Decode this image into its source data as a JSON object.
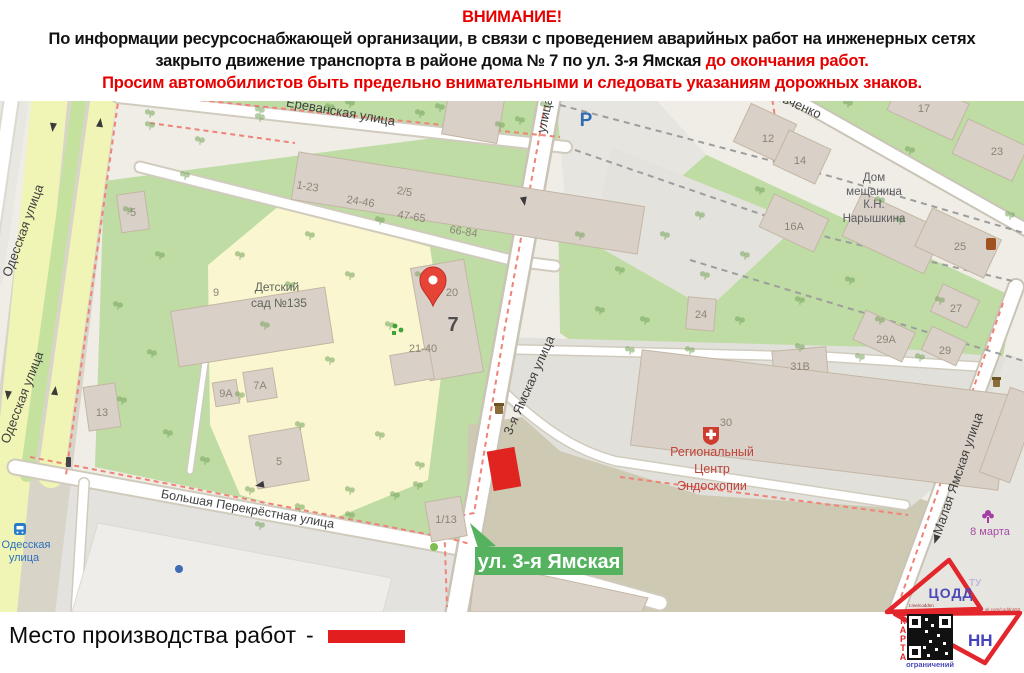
{
  "notice": {
    "line1": "ВНИМАНИЕ!",
    "line2": "По информации ресурсоснабжающей организации, в связи с проведением аварийных работ на инженерных сетях",
    "line3_black": "закрыто движение транспорта в районе дома № 7 по ул. 3-я Ямская ",
    "line3_red": "до окончания работ.",
    "line4": "Просим автомобилистов быть предельно внимательными и следовать указаниям дорожных знаков."
  },
  "legend": {
    "label": "Место производства работ",
    "dash": "-"
  },
  "colors": {
    "notice_red": "#e60000",
    "work_marker_red": "#e02420",
    "banner_green": "#55b25e",
    "logo_red": "#e3262c",
    "logo_blue": "#4b49b8"
  },
  "map": {
    "banner": "ул. 3-я Ямская",
    "parking": "P",
    "streets": {
      "yerevanskaya": "Ереванская улица",
      "odesskaya": "Одесская улица",
      "yamskaya_top": "улица",
      "yamskaya": "3-я Ямская улица",
      "perekrestnaya": "Большая Перекрёстная улица",
      "malaya_yamskaya": "Малая Ямская улица",
      "shevchenko": "евченко"
    },
    "pois": {
      "kindergarten": [
        "Детский",
        "сад №135"
      ],
      "endoscopy": [
        "Региональный",
        "Центр",
        "Эндоскопии"
      ],
      "naryshkin": [
        "Дом",
        "мещанина",
        "К.Н.",
        "Нарышкина"
      ],
      "march8": "8 марта",
      "stop": [
        "Одесская",
        "улица"
      ]
    },
    "buildings": {
      "b5_north": "5",
      "b9": "9",
      "b13": "13",
      "b9a": "9А",
      "b7a": "7А",
      "b5_south": "5",
      "b1_13": "1/13",
      "row_1_23": "1-23",
      "row_2_5": "2/5",
      "row_24_46": "24-46",
      "row_47_65": "47-65",
      "row_66_84": "66-84",
      "b20": "20",
      "b7": "7",
      "b21_40": "21-40",
      "b12": "12",
      "b14": "14",
      "b16a": "16А",
      "b17": "17",
      "b23": "23",
      "b24": "24",
      "b25": "25",
      "b27": "27",
      "b29a": "29А",
      "b29": "29",
      "b30": "30",
      "b31v": "31В"
    }
  },
  "logo": {
    "codd": "ЦОДД",
    "nn": "НН",
    "karta": "КАРТА",
    "restrictions": "ограничений",
    "tg": "t.me/coddnn",
    "vk": "vk.com/coddnn52",
    "tu": "ТУ"
  }
}
